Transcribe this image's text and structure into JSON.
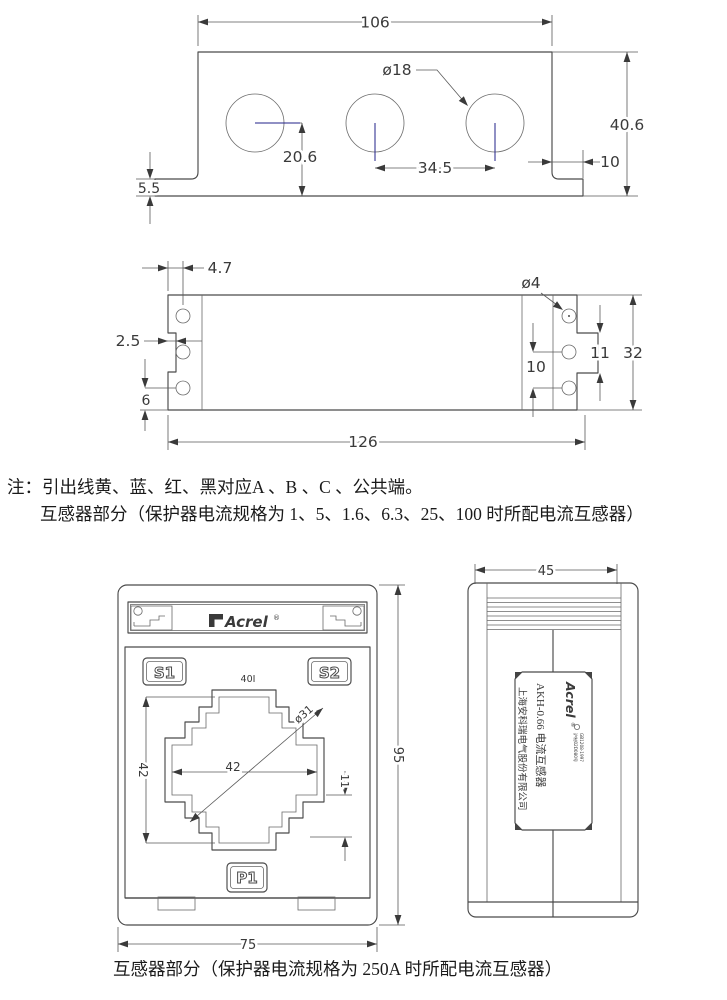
{
  "notes": {
    "line1": "注：引出线黄、蓝、红、黑对应A 、B 、C 、公共端。",
    "line2": "互感器部分（保护器电流规格为 1、5、1.6、6.3、25、100 时所配电流互感器）"
  },
  "caption": {
    "text": "互感器部分（保护器电流规格为 250A 时所配电流互感器）"
  },
  "figure1": {
    "dims": {
      "width_top": "106",
      "hole_dia": "ø18",
      "height": "40.6",
      "center_to_bottom": "20.6",
      "hole_spacing": "34.5",
      "flange_right_width": "10",
      "flange_height": "5.5"
    }
  },
  "figure2": {
    "dims": {
      "edge_to_hole": "4.7",
      "hole_dia": "ø4",
      "notch_depth": "2.5",
      "tab_height": "11",
      "height": "32",
      "hole_pitch": "10",
      "hole_to_bottom": "6",
      "width": "126"
    }
  },
  "figure3": {
    "brand": "Acrel",
    "reg": "®",
    "terminal_s1": "S1",
    "terminal_s2": "S2",
    "terminal_p1": "P1",
    "window_mark": "40I",
    "dims": {
      "window_width": "42",
      "window_height": "42",
      "window_dia": "ø31",
      "step": "11",
      "body_height": "95",
      "body_width": "75"
    }
  },
  "figure4": {
    "dims": {
      "depth": "45"
    },
    "label": {
      "brand": "Acrel",
      "reg": "®",
      "cert1": "沪制02D080号",
      "cert2": "GB1208-1997",
      "product": "AKH-0.66 电流互感器",
      "company": "上海安科瑞电气股份有限公司"
    }
  },
  "colors": {
    "line": "#4a4a4a",
    "centerline": "#20208a",
    "background": "#ffffff"
  }
}
